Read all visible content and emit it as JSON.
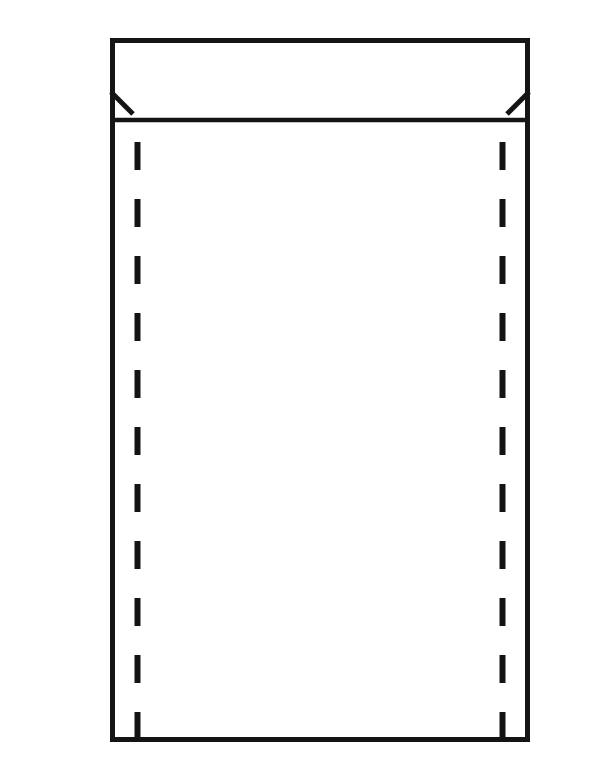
{
  "diagram": {
    "name": "envelope-line-drawing",
    "description": "Black-and-white line drawing of a sealed envelope / mailer seen from the back: top flap with fold line, small diagonal notches at the flap corners, and two vertical dashed seam lines inside the body",
    "background_color": "#ffffff",
    "line_color": "#141414",
    "canvas": {
      "width": 600,
      "height": 783
    },
    "envelope": {
      "outline": {
        "x": 112.5,
        "y": 40.5,
        "width": 415,
        "height": 699,
        "stroke_width": 5
      },
      "flap": {
        "fold_line": {
          "x1": 110,
          "y1": 120,
          "x2": 530,
          "y2": 120,
          "stroke_width": 4.5
        },
        "left_notch": {
          "x1": 111,
          "y1": 92,
          "x2": 133,
          "y2": 114,
          "stroke_width": 5
        },
        "right_notch": {
          "x1": 529,
          "y1": 92,
          "x2": 507,
          "y2": 114,
          "stroke_width": 5
        }
      },
      "seam_lines": {
        "stroke_width": 6,
        "dash_length": 28,
        "gap_length": 29,
        "left": {
          "x": 137.5,
          "y1": 142,
          "y2": 741
        },
        "right": {
          "x": 502.5,
          "y1": 142,
          "y2": 741
        }
      }
    }
  }
}
